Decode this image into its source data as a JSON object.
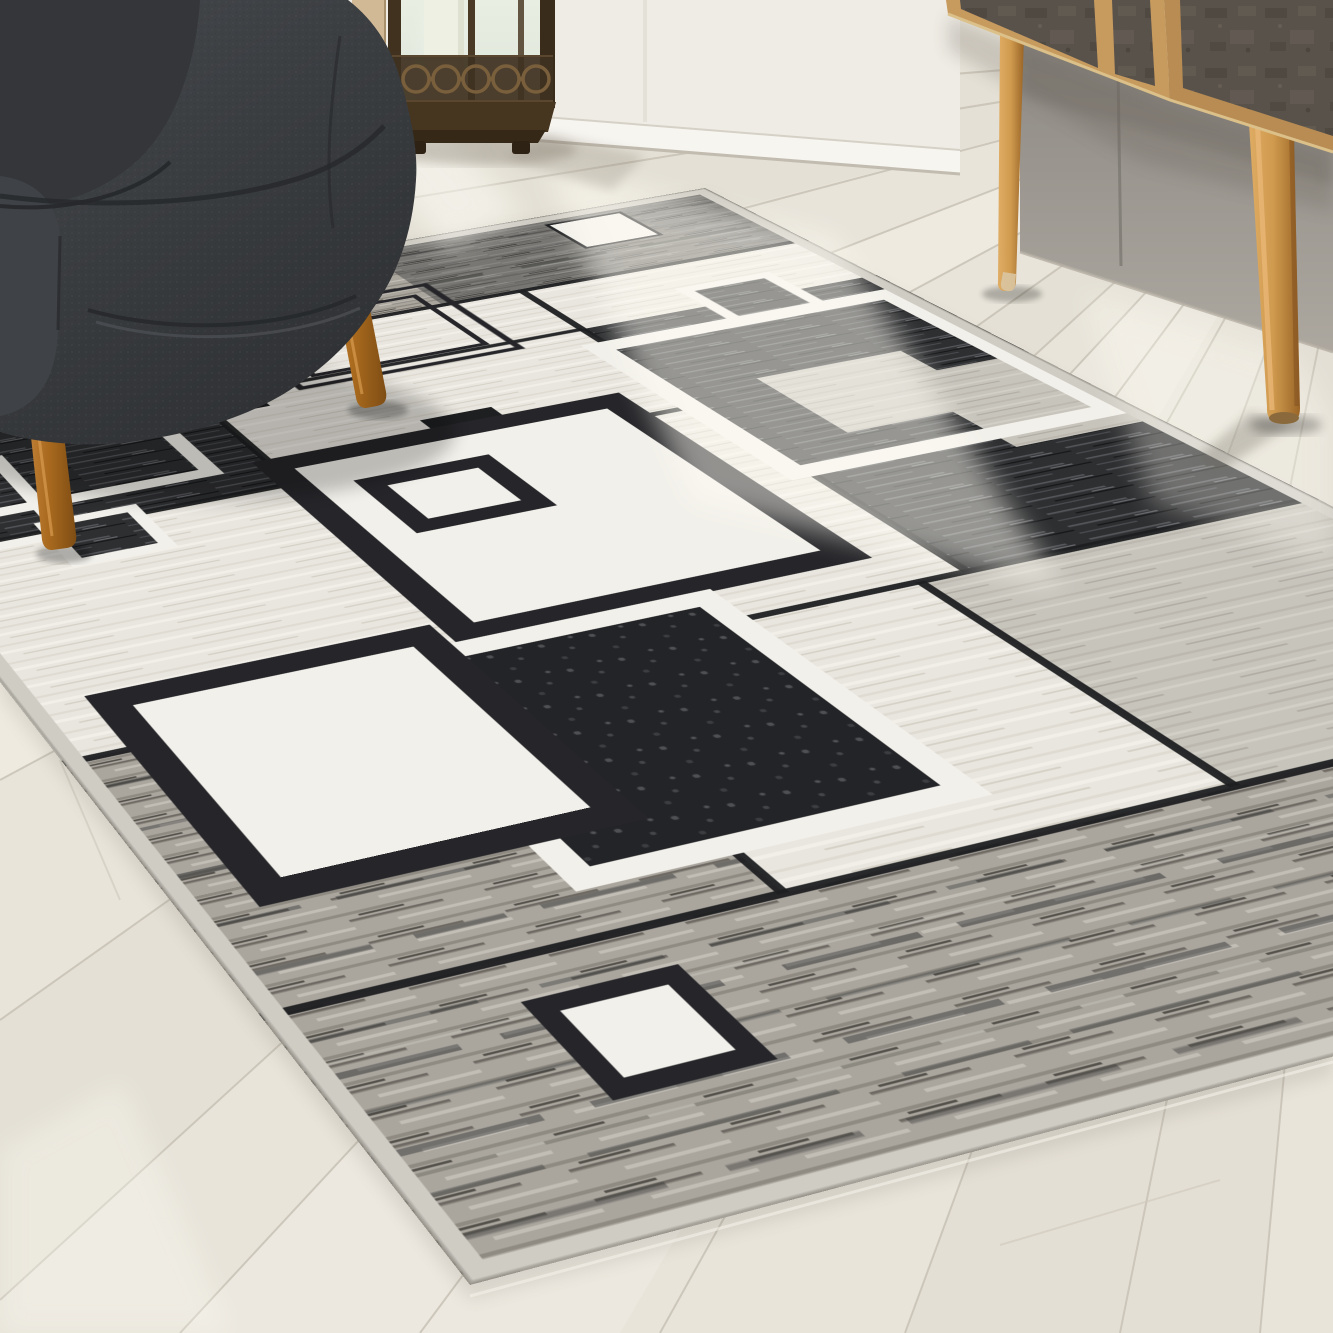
{
  "scene": {
    "description": "Product photo of a modern geometric area rug with overlapping black, charcoal, gray and cream squares, shown at an angle on a whitewashed wood plank floor in a living room with a dark charcoal fabric armchair, a bronze candle lantern and a mid-century oak sideboard with splayed legs.",
    "room": "living room",
    "lighting": "natural window light with bright sun glare streaks on the floor"
  },
  "palette": {
    "floor": "#e8e4da",
    "floor_line": "#c6c0b3",
    "wall_white": "#efece5",
    "baseboard": "#f7f5f0",
    "wall_gray": "#99958f",
    "oak": "#c79a5e",
    "oak_front": "#b88c52",
    "door_panel": "#59524b",
    "leg_wood_light": "#cf9a4e",
    "leg_wood_chair": "#a96a1e",
    "chair_fabric": "#3a3d40",
    "chair_fabric_dark": "#2f3134",
    "bronze": "#41321f",
    "candle_glass": "#dce5da",
    "rug_cream": "#e9e6df",
    "rug_white": "#f2f0ea",
    "rug_light_gray": "#c7c4bc",
    "rug_heather_gray": "#aaa69e",
    "rug_heather_black": "#2e2f31",
    "rug_black": "#1e1f21",
    "rug_binding": "#cfccc4"
  },
  "objects": {
    "armchair": {
      "label": "charcoal fabric armchair",
      "fabric": "dark charcoal woven",
      "legs": "tapered walnut wood",
      "position": "top left, front legs on rug"
    },
    "lantern": {
      "label": "bronze candle lantern",
      "glass": "frosted glass panels",
      "candle": "white pillar candle",
      "detail": "pierced ring band and stepped base",
      "position": "on floor by white wall"
    },
    "sideboard": {
      "label": "mid-century sideboard",
      "frame": "light oak",
      "doors": "dark slate panels",
      "legs": "splayed tapered oak",
      "position": "top right against gray wall"
    },
    "rug": {
      "label": "geometric area rug",
      "style": "overlapping outlined squares",
      "colors": [
        "black",
        "charcoal",
        "gray",
        "cream",
        "white"
      ],
      "edge": "gray bound edge",
      "position": "center, angled perspective"
    },
    "floor": {
      "label": "whitewashed wood plank floor"
    },
    "walls": {
      "left": "white wall with baseboard",
      "right": "shadowed gray wall corner"
    }
  },
  "rug_pattern": {
    "local_size": [
      1000,
      1400
    ],
    "quad": {
      "tl": [
        -255,
        355
      ],
      "tr": [
        705,
        188
      ],
      "br": [
        2045,
        868
      ],
      "bl": [
        470,
        1285
      ]
    },
    "blocks": [
      {
        "t": "rect",
        "x": 0,
        "y": 0,
        "w": 1000,
        "h": 175,
        "f": "hgray"
      },
      {
        "t": "rect",
        "x": 620,
        "y": 0,
        "w": 380,
        "h": 175,
        "f": "hblack",
        "o": 0.4
      },
      {
        "t": "rect",
        "x": 0,
        "y": 175,
        "w": 330,
        "h": 305,
        "f": "hblack"
      },
      {
        "t": "rect",
        "x": 330,
        "y": 175,
        "w": 370,
        "h": 305,
        "f": "cream"
      },
      {
        "t": "rect",
        "x": 700,
        "y": 175,
        "w": 300,
        "h": 110,
        "f": "cream"
      },
      {
        "t": "rect",
        "x": 700,
        "y": 285,
        "w": 300,
        "h": 545,
        "f": "hblack"
      },
      {
        "t": "rect",
        "x": 0,
        "y": 480,
        "w": 360,
        "h": 350,
        "f": "cream"
      },
      {
        "t": "rect",
        "x": 360,
        "y": 480,
        "w": 340,
        "h": 350,
        "f": "cream"
      },
      {
        "t": "rect",
        "x": 0,
        "y": 830,
        "w": 340,
        "h": 320,
        "f": "hgray"
      },
      {
        "t": "rect",
        "x": 340,
        "y": 830,
        "w": 320,
        "h": 320,
        "f": "cream"
      },
      {
        "t": "rect",
        "x": 660,
        "y": 830,
        "w": 340,
        "h": 320,
        "f": "lgray"
      },
      {
        "t": "rect",
        "x": 0,
        "y": 1150,
        "w": 1000,
        "h": 250,
        "f": "hgray"
      }
    ],
    "elements": [
      {
        "t": "line",
        "x1": 0,
        "y1": 175,
        "x2": 1000,
        "y2": 175,
        "s": "seam",
        "sw": 8
      },
      {
        "t": "line",
        "x1": 330,
        "y1": 285,
        "x2": 700,
        "y2": 285,
        "s": "seam",
        "sw": 7
      },
      {
        "t": "line",
        "x1": 0,
        "y1": 480,
        "x2": 700,
        "y2": 480,
        "s": "seam",
        "sw": 8
      },
      {
        "t": "line",
        "x1": 0,
        "y1": 830,
        "x2": 1000,
        "y2": 830,
        "s": "seam",
        "sw": 8
      },
      {
        "t": "line",
        "x1": 0,
        "y1": 1150,
        "x2": 1000,
        "y2": 1150,
        "s": "seam",
        "sw": 8
      },
      {
        "t": "line",
        "x1": 330,
        "y1": 175,
        "x2": 330,
        "y2": 480,
        "s": "seam",
        "sw": 8
      },
      {
        "t": "line",
        "x1": 700,
        "y1": 175,
        "x2": 700,
        "y2": 830,
        "s": "seam",
        "sw": 8
      },
      {
        "t": "line",
        "x1": 360,
        "y1": 480,
        "x2": 360,
        "y2": 830,
        "s": "seam",
        "sw": 8
      },
      {
        "t": "line",
        "x1": 340,
        "y1": 830,
        "x2": 340,
        "y2": 1150,
        "s": "seam",
        "sw": 8
      },
      {
        "t": "line",
        "x1": 660,
        "y1": 830,
        "x2": 660,
        "y2": 1150,
        "s": "seam",
        "sw": 8
      },
      {
        "t": "rect",
        "x": 230,
        "y": 30,
        "w": 220,
        "h": 220,
        "f": "hblack"
      },
      {
        "t": "orect",
        "x": 252,
        "y": 52,
        "w": 176,
        "h": 176,
        "s": "white",
        "sw": 12
      },
      {
        "t": "rect",
        "x": 810,
        "y": 25,
        "w": 80,
        "h": 75,
        "f": "white"
      },
      {
        "t": "orect",
        "x": 810,
        "y": 25,
        "w": 80,
        "h": 75,
        "s": "seam",
        "sw": 4
      },
      {
        "t": "orect",
        "x": 140,
        "y": 120,
        "w": 130,
        "h": 120,
        "s": "black",
        "sw": 7
      },
      {
        "t": "orect",
        "x": 420,
        "y": 120,
        "w": 210,
        "h": 180,
        "s": "black",
        "sw": 7
      },
      {
        "t": "orect",
        "x": 442,
        "y": 142,
        "w": 166,
        "h": 136,
        "s": "black",
        "sw": 6
      },
      {
        "t": "orect",
        "x": 40,
        "y": 200,
        "w": 240,
        "h": 230,
        "s": "white",
        "sw": 16
      },
      {
        "t": "orect",
        "x": -50,
        "y": 330,
        "w": 180,
        "h": 160,
        "s": "white",
        "sw": 14
      },
      {
        "t": "rect",
        "x": 320,
        "y": 268,
        "w": 60,
        "h": 56,
        "f": "black"
      },
      {
        "t": "rect",
        "x": 830,
        "y": 240,
        "w": 85,
        "h": 85,
        "f": "hblack"
      },
      {
        "t": "orect",
        "x": 830,
        "y": 240,
        "w": 85,
        "h": 85,
        "s": "white",
        "sw": 13
      },
      {
        "t": "rect",
        "x": 120,
        "y": 468,
        "w": 75,
        "h": 75,
        "f": "hblack"
      },
      {
        "t": "orect",
        "x": 120,
        "y": 468,
        "w": 75,
        "h": 75,
        "s": "white",
        "sw": 12
      },
      {
        "t": "rect",
        "x": 478,
        "y": 408,
        "w": 66,
        "h": 60,
        "f": "black"
      },
      {
        "t": "rect",
        "x": 330,
        "y": 440,
        "w": 310,
        "h": 330,
        "f": "white"
      },
      {
        "t": "orect",
        "x": 330,
        "y": 440,
        "w": 310,
        "h": 330,
        "s": "black",
        "sw": 26
      },
      {
        "t": "orect",
        "x": 385,
        "y": 505,
        "w": 100,
        "h": 90,
        "s": "black",
        "sw": 20
      },
      {
        "t": "rect",
        "x": 690,
        "y": 330,
        "w": 290,
        "h": 300,
        "f": "hblack"
      },
      {
        "t": "rect",
        "x": 770,
        "y": 450,
        "w": 140,
        "h": 130,
        "f": "lgray"
      },
      {
        "t": "rect",
        "x": 868,
        "y": 500,
        "w": 150,
        "h": 160,
        "f": "lgray"
      },
      {
        "t": "orect",
        "x": 690,
        "y": 330,
        "w": 290,
        "h": 300,
        "s": "white",
        "sw": 22
      },
      {
        "t": "rect",
        "x": 240,
        "y": 790,
        "w": 270,
        "h": 300,
        "f": "hbdense"
      },
      {
        "t": "orect",
        "x": 240,
        "y": 790,
        "w": 270,
        "h": 300,
        "s": "white",
        "sw": 22
      },
      {
        "t": "rect",
        "x": 60,
        "y": 760,
        "w": 240,
        "h": 270,
        "f": "white"
      },
      {
        "t": "orect",
        "x": 60,
        "y": 760,
        "w": 240,
        "h": 270,
        "s": "black",
        "sw": 26
      },
      {
        "t": "rect",
        "x": 150,
        "y": 1200,
        "w": 85,
        "h": 85,
        "f": "white"
      },
      {
        "t": "orect",
        "x": 150,
        "y": 1200,
        "w": 85,
        "h": 85,
        "s": "black",
        "sw": 16
      }
    ]
  }
}
